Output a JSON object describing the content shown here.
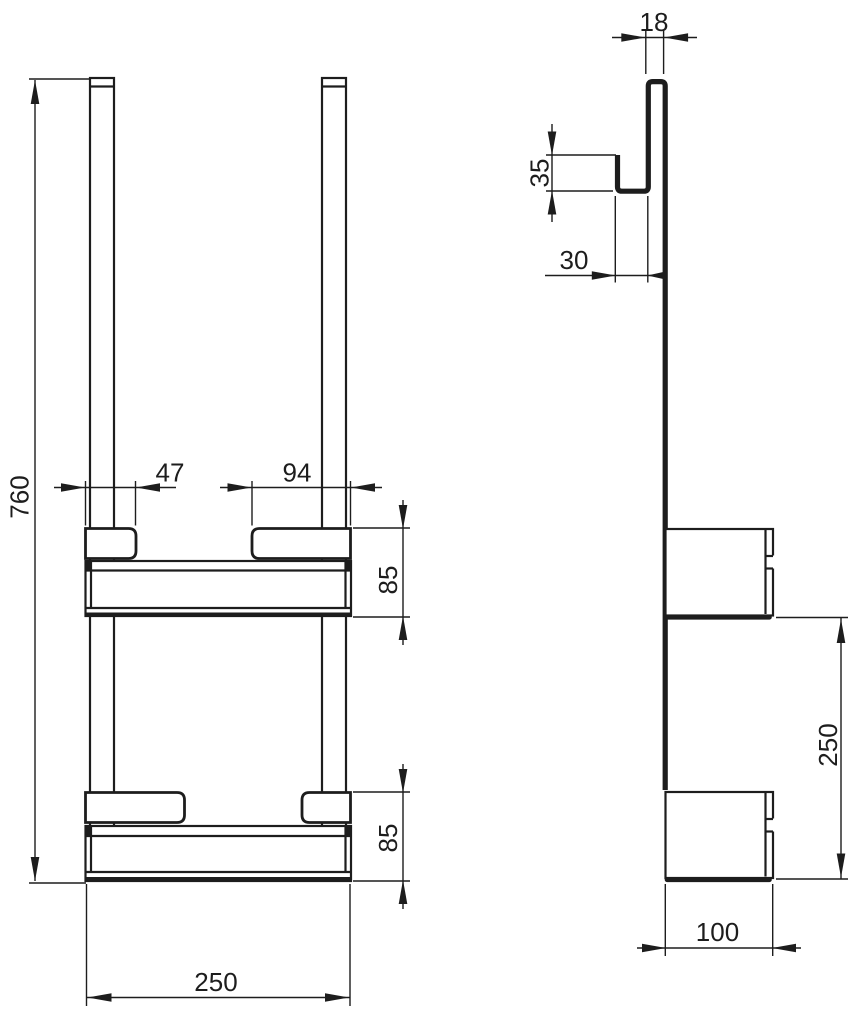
{
  "drawing": {
    "background_color": "#ffffff",
    "line_color": "#1d1d1d",
    "front_view": {
      "dim_overall_height": "760",
      "dim_left_mount_width": "47",
      "dim_right_mount_width": "94",
      "dim_upper_basket_height": "85",
      "dim_lower_basket_height": "85",
      "dim_overall_width": "250"
    },
    "side_view": {
      "dim_hook_gap_width": "18",
      "dim_hook_return_height": "35",
      "dim_hook_depth": "30",
      "dim_basket_spacing": "250",
      "dim_basket_depth": "100"
    }
  }
}
